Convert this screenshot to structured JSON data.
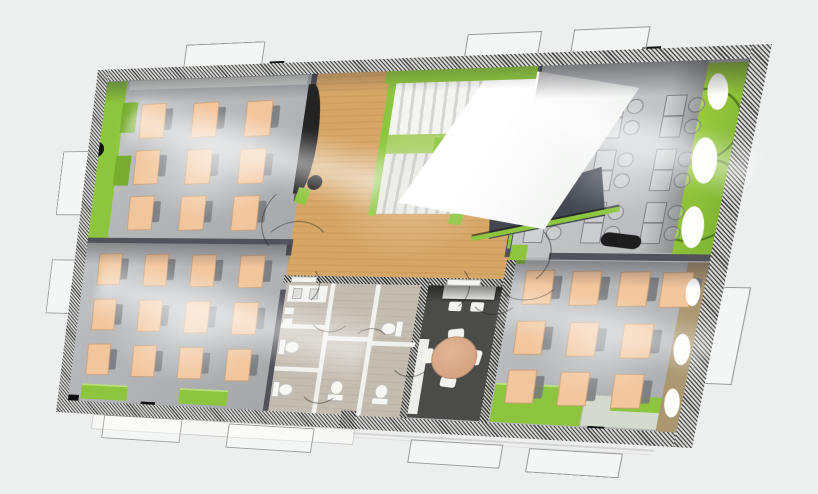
{
  "scene": {
    "description": "aerial perspective render of a single floor plan with four classrooms, central wooden hall with staircase and white skylight canopy, bathroom core, dark meeting room",
    "background_color": "#edeeee"
  },
  "palette": {
    "lime_accent": "#8dc63e",
    "lime_bright": "#9ccc3c",
    "lime_pale": "#cfe3a6",
    "wood_floor": "#d7a768",
    "floor_gray": "#b2b4b7",
    "floor_gray_light": "#c6c8ca",
    "desk_peach": "#f2c69d",
    "chair_gray": "#76787c",
    "meeting_room_dark": "#4b4b49",
    "table_tan": "#d9a98b",
    "bathroom_tile": "#cdc6ba",
    "fixture_white": "#f5f5f2",
    "void_dark": "#424750",
    "tan_band": "#ab9770",
    "wall_dark": "#52525a"
  },
  "rooms": [
    {
      "id": "classroom-top-left",
      "desks": 9
    },
    {
      "id": "classroom-bottom-left",
      "desks": 12
    },
    {
      "id": "classroom-top-right",
      "desks": 9,
      "style": "wireframe outline desks with chair circles"
    },
    {
      "id": "classroom-bottom-right",
      "desks": 10
    },
    {
      "id": "meeting-room",
      "furniture": "round table with 4 chairs, wall desk with 2 chairs"
    },
    {
      "id": "bathroom-core",
      "toilets": 5
    },
    {
      "id": "central-hall",
      "features": "wood floor, staircase, white skylight canopy, stair void"
    }
  ],
  "furniture": {
    "desk_grids": [
      {
        "room": "classroom-top-left",
        "origin": [
          58,
          40
        ],
        "cols": 3,
        "rows": 3,
        "dx": 60,
        "dy": 52,
        "w": 27,
        "h": 37
      },
      {
        "room": "classroom-bottom-left",
        "origin": [
          30,
          210
        ],
        "cols": 4,
        "rows": 3,
        "dx": 55,
        "dy": 53,
        "w": 26,
        "h": 35
      },
      {
        "room": "classroom-bottom-right",
        "rows_spec": [
          {
            "y": 222,
            "xs": [
              495,
              540,
              585,
              624
            ]
          },
          {
            "y": 275,
            "xs": [
              495,
              546,
              597
            ]
          },
          {
            "y": 327,
            "xs": [
              495,
              546,
              597
            ]
          }
        ],
        "w": 26,
        "h": 34
      }
    ],
    "wire_desk_grid": {
      "room": "classroom-top-right",
      "origin": [
        486,
        46
      ],
      "cols": 3,
      "rows": 3,
      "dx": 55,
      "dy": 53
    }
  },
  "fixtures": {
    "toilets": [
      [
        254,
        300,
        -90
      ],
      [
        254,
        348,
        -90
      ],
      [
        312,
        346,
        180
      ],
      [
        360,
        276,
        90
      ],
      [
        360,
        348,
        180
      ]
    ],
    "door_arcs": [
      [
        252,
        170,
        40,
        270
      ],
      [
        252,
        212,
        40,
        0
      ],
      [
        480,
        206,
        34,
        90
      ],
      [
        496,
        214,
        38,
        180
      ],
      [
        414,
        242,
        26,
        90
      ],
      [
        468,
        242,
        26,
        180
      ],
      [
        302,
        268,
        24,
        180
      ],
      [
        302,
        350,
        22,
        180
      ],
      [
        348,
        308,
        20,
        0
      ],
      [
        394,
        316,
        22,
        180
      ],
      [
        262,
        242,
        22,
        90
      ]
    ],
    "round_columns": [
      [
        2,
        82,
        17
      ],
      [
        256,
        122,
        16
      ],
      [
        420,
        146,
        18
      ]
    ],
    "column_bases": [
      [
        246,
        136,
        13,
        17,
        12
      ],
      [
        410,
        158,
        13,
        17,
        8
      ]
    ]
  },
  "walls": {
    "black_wall_columns": [
      [
        196,
        -2,
        16,
        14
      ],
      [
        566,
        -2,
        17,
        14
      ],
      [
        8,
        378,
        18,
        16
      ],
      [
        102,
        382,
        17,
        14
      ],
      [
        288,
        385,
        16,
        13
      ],
      [
        458,
        387,
        16,
        12
      ],
      [
        580,
        383,
        16,
        13
      ]
    ],
    "white_windows": [
      [
        96,
        1,
        86,
        11
      ],
      [
        396,
        1,
        66,
        11
      ],
      [
        497,
        1,
        66,
        11
      ],
      [
        28,
        387,
        70,
        11
      ],
      [
        122,
        387,
        106,
        11
      ],
      [
        300,
        389,
        30,
        9
      ],
      [
        370,
        389,
        78,
        9
      ],
      [
        478,
        389,
        88,
        9
      ],
      [
        600,
        387,
        40,
        11
      ],
      [
        1,
        96,
        11,
        64
      ],
      [
        1,
        220,
        11,
        56
      ],
      [
        340,
        14,
        14,
        11
      ],
      [
        378,
        14,
        12,
        11
      ],
      [
        420,
        14,
        12,
        11
      ],
      [
        254,
        233,
        28,
        7
      ],
      [
        418,
        233,
        34,
        7
      ]
    ],
    "lime_segments": [
      [
        236,
        1,
        86,
        11
      ],
      [
        588,
        1,
        44,
        11
      ],
      [
        322,
        13,
        150,
        13
      ]
    ],
    "window_outlines": [
      [
        100,
        -24,
        86,
        24
      ],
      [
        398,
        -22,
        70,
        22
      ],
      [
        500,
        -22,
        68,
        22
      ],
      [
        -30,
        92,
        30,
        72
      ],
      [
        -28,
        218,
        28,
        62
      ],
      [
        60,
        400,
        92,
        26
      ],
      [
        208,
        402,
        94,
        26
      ],
      [
        408,
        408,
        92,
        24
      ],
      [
        528,
        410,
        88,
        24
      ],
      [
        668,
        236,
        34,
        96
      ]
    ],
    "right_wall_dashes": [
      48,
      76,
      122,
      158,
      198,
      240,
      278,
      312
    ]
  },
  "decor": {
    "green_band_ovals": [
      [
        632,
        26,
        18,
        36,
        -12
      ],
      [
        630,
        88,
        22,
        46,
        -10
      ],
      [
        632,
        156,
        20,
        42,
        -8
      ]
    ],
    "tan_band_ovals": [
      [
        647,
        228,
        13,
        28,
        -8
      ],
      [
        646,
        284,
        15,
        32,
        -8
      ],
      [
        647,
        340,
        14,
        30,
        -8
      ]
    ],
    "dark_pill_column": [
      560,
      184,
      38,
      14,
      7
    ]
  },
  "atmosphere": {
    "fog": [
      [
        20,
        25,
        250,
        170,
        0.55
      ],
      [
        10,
        205,
        270,
        180,
        0.5
      ],
      [
        470,
        30,
        200,
        160,
        0.45
      ],
      [
        485,
        225,
        185,
        150,
        0.42
      ],
      [
        250,
        40,
        240,
        200,
        0.3
      ]
    ],
    "streaks": [
      [
        40,
        60,
        300,
        70,
        14,
        0.55
      ],
      [
        30,
        240,
        320,
        80,
        12,
        0.5
      ],
      [
        470,
        60,
        220,
        60,
        18,
        0.5
      ],
      [
        480,
        250,
        200,
        60,
        12,
        0.4
      ]
    ]
  }
}
